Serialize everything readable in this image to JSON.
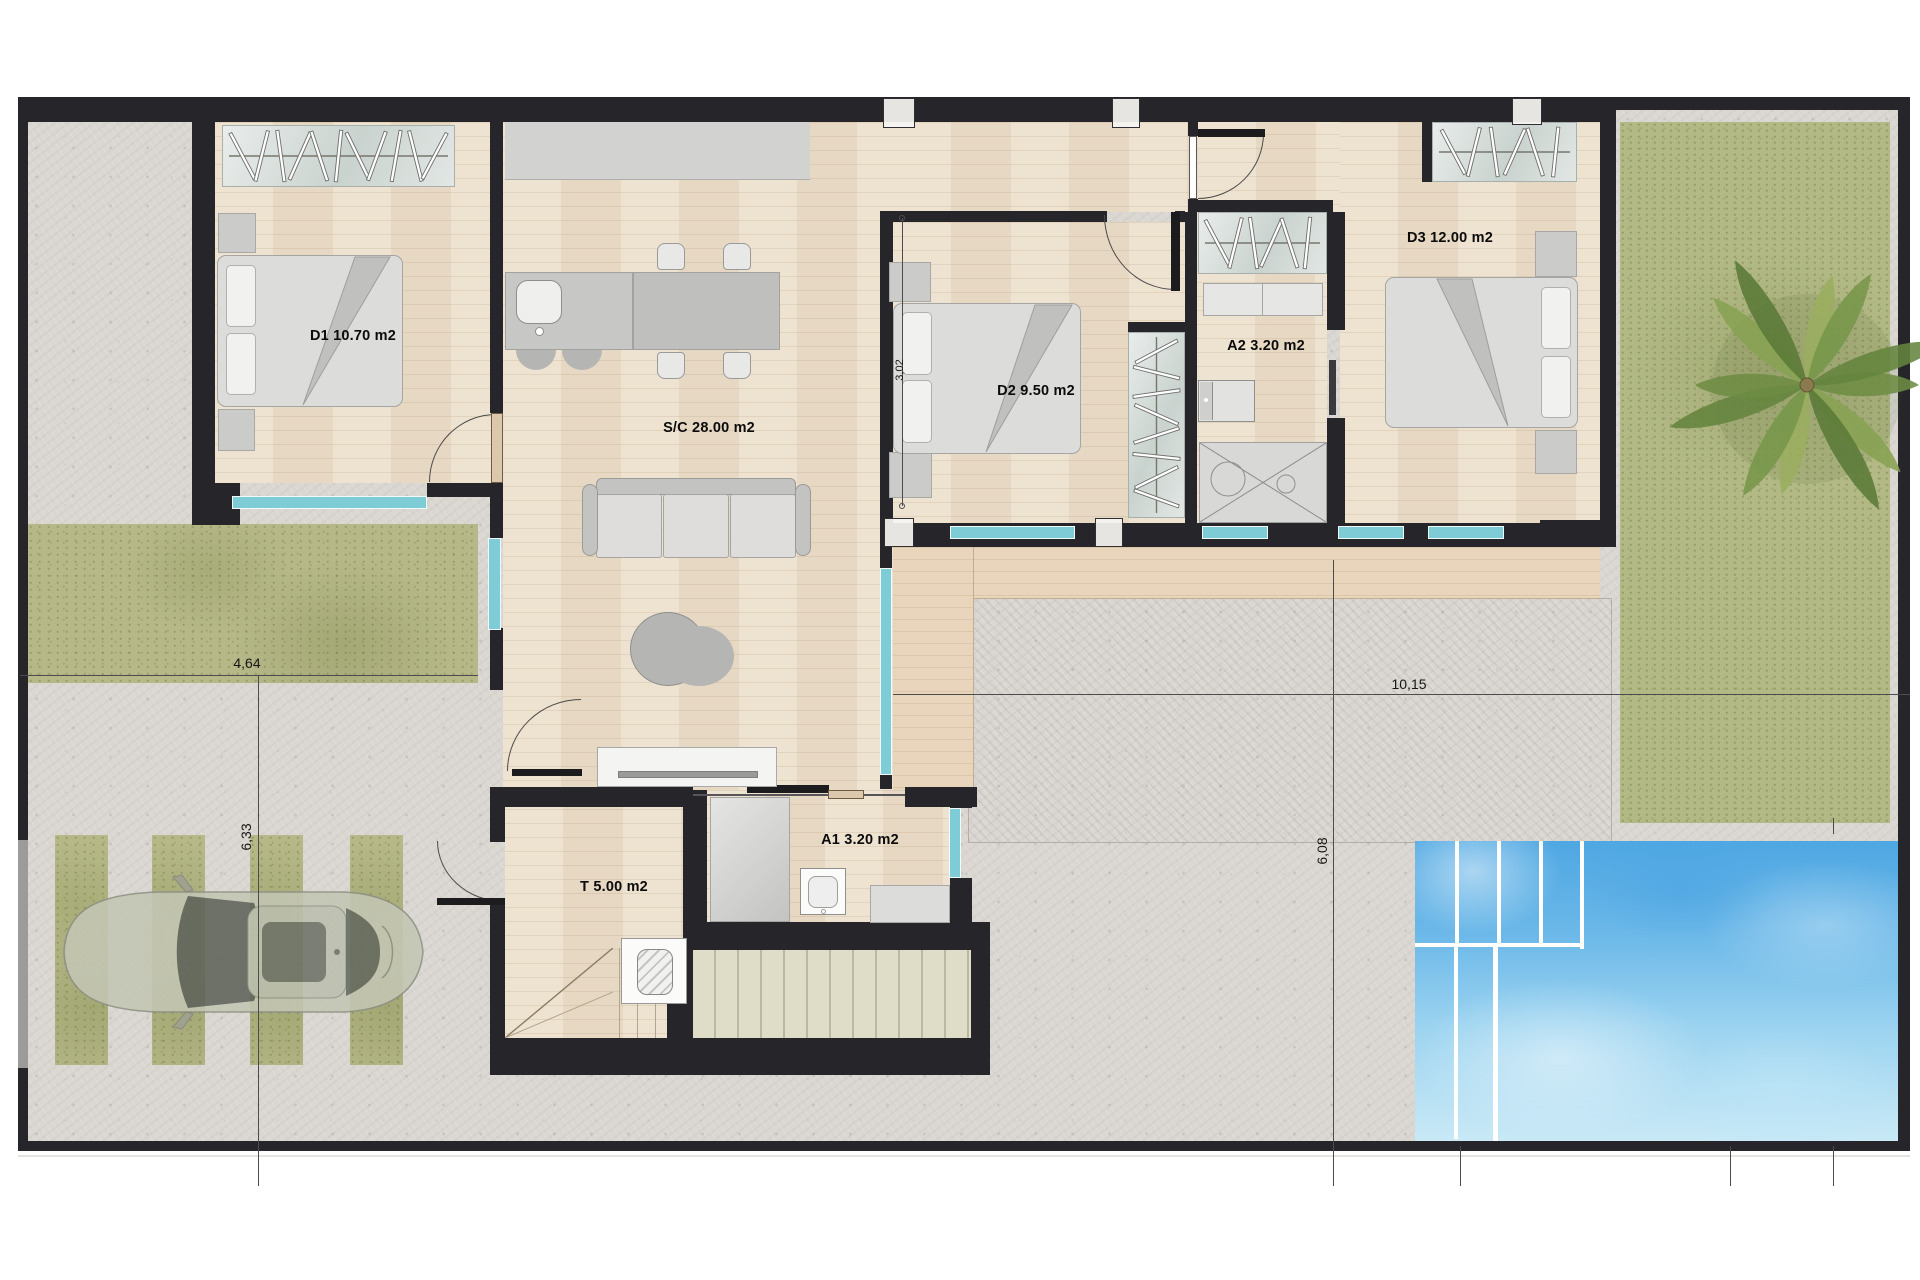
{
  "document": {
    "type": "architectural-floor-plan"
  },
  "rooms": [
    {
      "id": "D1",
      "label": "D1 10.70 m2"
    },
    {
      "id": "SC",
      "label": "S/C 28.00 m2"
    },
    {
      "id": "D2",
      "label": "D2 9.50 m2"
    },
    {
      "id": "A2",
      "label": "A2 3.20 m2"
    },
    {
      "id": "D3",
      "label": "D3 12.00 m2"
    },
    {
      "id": "A1",
      "label": "A1 3.20 m2"
    },
    {
      "id": "T",
      "label": "T 5.00 m2"
    }
  ],
  "dimensions": [
    {
      "id": "left-width",
      "label": "4,64"
    },
    {
      "id": "left-height",
      "label": "6,33"
    },
    {
      "id": "right-width",
      "label": "10,15"
    },
    {
      "id": "right-height",
      "label": "6,08"
    },
    {
      "id": "d2-width",
      "label": "3,02"
    }
  ],
  "colors": {
    "wall": "#26262a",
    "wood_floor": "#ecdfcb",
    "deck": "#e8d5bc",
    "concrete": "#dad7d2",
    "grass": "#b6b888",
    "window_glass": "#7dccd6",
    "pool_water": "#5aaee4",
    "furniture": "#d9d9d7"
  }
}
